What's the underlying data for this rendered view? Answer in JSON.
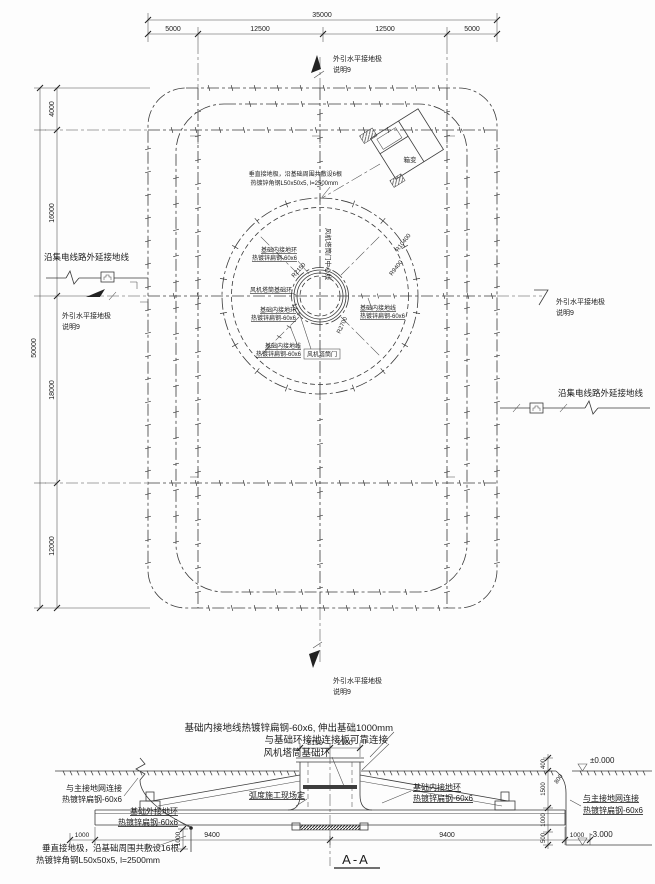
{
  "plan": {
    "dim_top_total": "35000",
    "dim_top_segments": [
      "5000",
      "12500",
      "12500",
      "5000"
    ],
    "dim_left_total": "50000",
    "dim_left_segments": [
      "4000",
      "16000",
      "18000",
      "12000"
    ],
    "note_top": {
      "l1": "外引水平接地极",
      "l2": "说明9"
    },
    "note_bottom": {
      "l1": "外引水平接地极",
      "l2": "说明9"
    },
    "note_left_arrow": {
      "l1": "外引水平接地极",
      "l2": "说明9"
    },
    "note_right_arrow": {
      "l1": "外引水平接地极",
      "l2": "说明9"
    },
    "note_left_collector": "沿集电线路外延接地线",
    "note_right_collector": "沿集电线路外延接地线",
    "note_vertical_rods": {
      "l1": "垂直接地极，沿基础周围共敷设6根",
      "l2": "热镀锌角钢L50x50x5, l=2500mm"
    },
    "door_centerline": "风机塔筒门中心线",
    "transformer": "箱变",
    "r_outer": "R10400",
    "r_outer2": "R9400",
    "r_mid": "R2700",
    "r_inner": "R2150",
    "lbl_inner_ring_a": {
      "l1": "基础内接地环",
      "l2": "热镀锌扁钢-60x6"
    },
    "lbl_tower_ring": "风机塔筒基础环",
    "lbl_inner_ring_b": {
      "l1": "基础内接地环",
      "l2": "热镀锌扁钢-60x6"
    },
    "lbl_inner_line_a": {
      "l1": "基础内接地线",
      "l2": "热镀锌扁钢-60x6"
    },
    "lbl_inner_line_b": {
      "l1": "基础内接地线",
      "l2": "热镀锌扁钢-60x6"
    },
    "lbl_tower_door": "风机塔筒门"
  },
  "section": {
    "title": "A-A",
    "note1": "基础内接地线热镀锌扁钢-60x6, 伸出基础1000mm",
    "note2": "与基础环接地连接板可靠连接",
    "note3": "风机塔筒基础环",
    "lbl_main_grid_left": {
      "l1": "与主接地网连接",
      "l2": "热镀锌扁钢-60x6"
    },
    "lbl_outer_ring": {
      "l1": "基础外接地环",
      "l2": "热镀锌扁钢-60x6"
    },
    "lbl_arc_site": "弧度施工现场定",
    "lbl_inner_ring": {
      "l1": "基础内接地环",
      "l2": "热镀锌扁钢-60x6"
    },
    "lbl_main_grid_right": {
      "l1": "与主接地网连接",
      "l2": "热镀锌扁钢-60x6"
    },
    "note_rods": {
      "l1": "垂直接地极，沿基础周围共敷设16根",
      "l2": "热镀锌角钢L50x50x5, l=2500mm"
    },
    "elev_zero": "±0.000",
    "elev_neg": "-3.000",
    "dim_2150_l": "2150",
    "dim_2150_r": "2150",
    "dim_bottom": [
      "1000",
      "9400",
      "9400",
      "1000"
    ],
    "dim_v_1000": "1000",
    "dim_400": "400",
    "dim_1500": "1500",
    "dim_1000m": "1000",
    "dim_500": "500",
    "dim_800": "800"
  },
  "colors": {
    "line": "#3a3a3a",
    "text": "#1c1c1c",
    "fill_dark": "#3d3d3d"
  }
}
